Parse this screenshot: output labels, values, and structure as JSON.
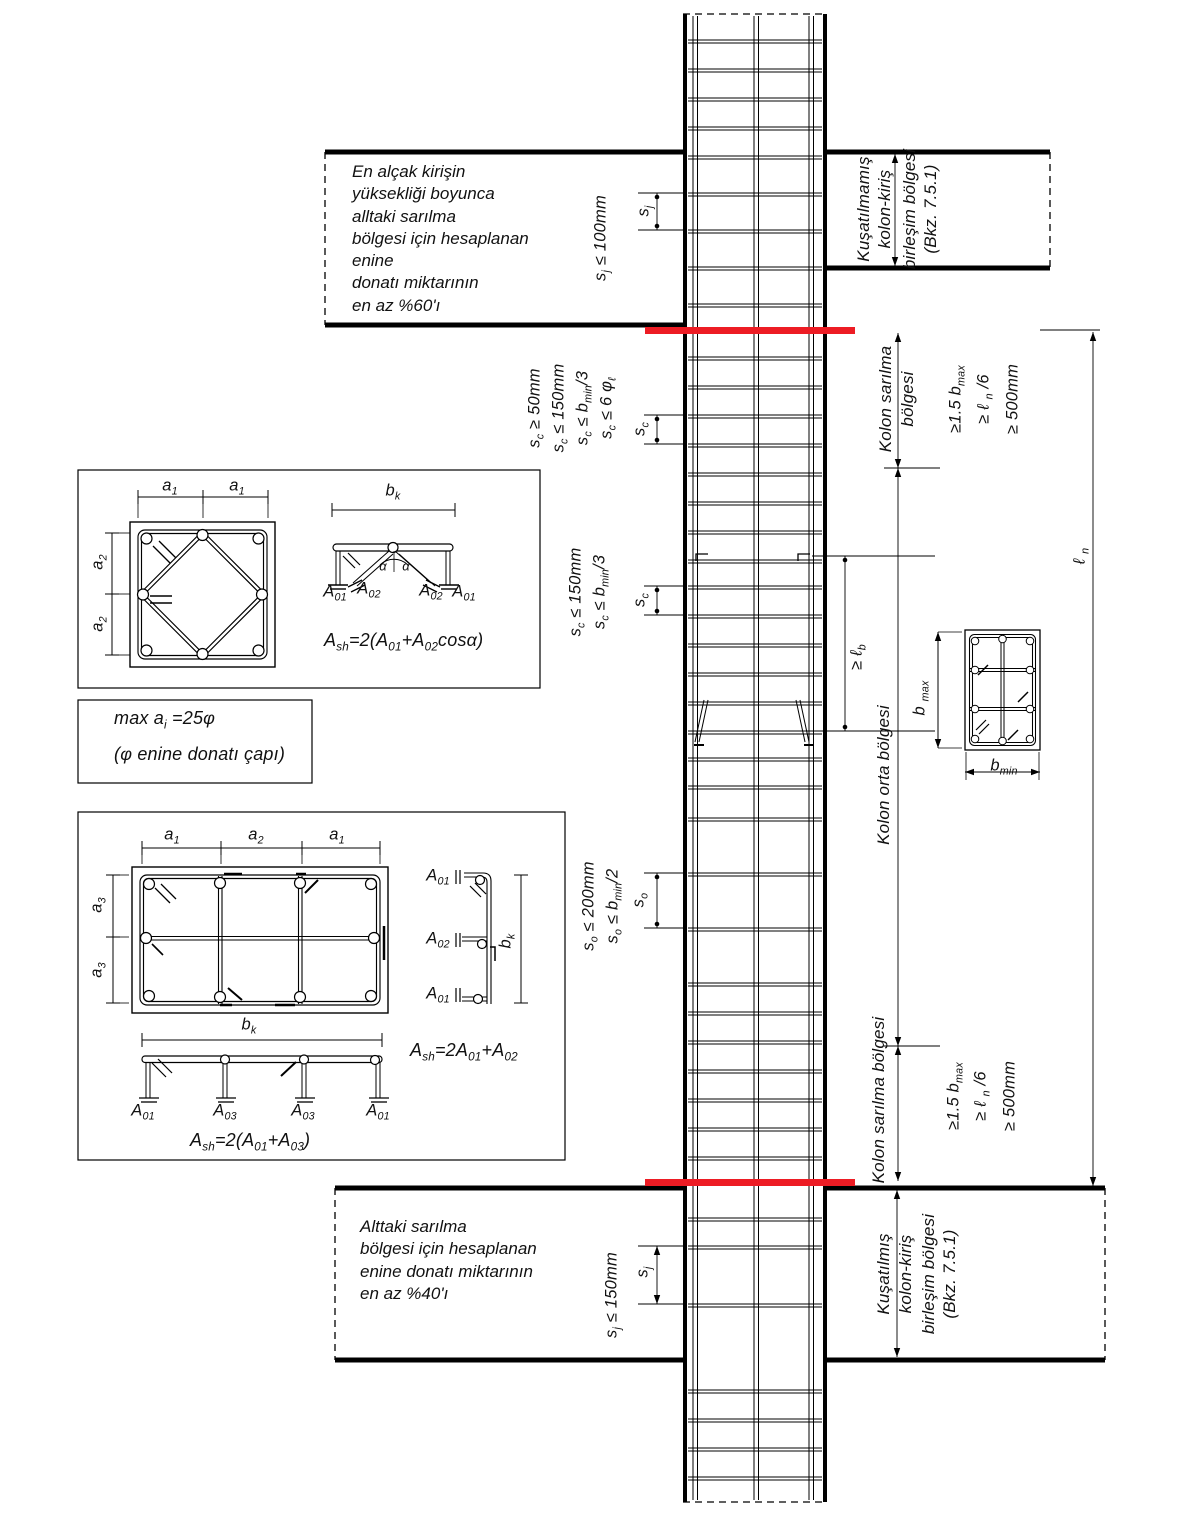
{
  "accent_color": "#ed1c24",
  "notes": {
    "top_left": "En alçak kirişin\nyüksekliği boyunca\nalltaki sarılma\nbölgesi için hesaplanan\nenine\ndonatı miktarının\nen az %60'ı",
    "bottom_left": "Alttaki sarılma\nbölgesi için hesaplanan\nenine donatı miktarının\nen az %40'ı",
    "max_spacing_1": "max a<sub>i</sub> =25φ",
    "max_spacing_2": "(φ enine donatı çapı)"
  },
  "joints": {
    "top": [
      "Kuşatılmamış",
      "kolon-kiriş",
      "birleşim bölgesi",
      "(Bkz. 7.5.1)"
    ],
    "bottom": [
      "Kuşatılmış",
      "kolon-kiriş",
      "birleşim bölgesi",
      "(Bkz. 7.5.1)"
    ]
  },
  "zones": {
    "top_confinement_1": "Kolon sarılma",
    "top_confinement_2": "bölgesi",
    "middle": "Kolon orta bölgesi",
    "bottom_confinement": "Kolon sarılma bölgesi",
    "limit_1": "≥1.5 b<sub>max</sub>",
    "limit_2": "≥ ℓ <sub>n</sub> /6",
    "limit_3": "≥ 500mm"
  },
  "spacing": {
    "sj_top_rule": "s<sub>j</sub> ≤ 100mm",
    "sj_bottom_rule": "s<sub>j</sub> ≤ 150mm",
    "sj_dim": "s<sub>j</sub>",
    "sc_dim": "s<sub>c</sub>",
    "so_dim": "s<sub>o</sub>",
    "sc_top_rule_1": "s<sub>c</sub> ≥ 50mm",
    "sc_top_rule_2": "s<sub>c</sub> ≤ 150mm",
    "sc_top_rule_3": "s<sub>c</sub> ≤ b<sub>min</sub>/3",
    "sc_top_rule_4": "s<sub>c</sub> ≤ 6 φ<sub>ℓ</sub>",
    "sc_mid_rule_1": "s<sub>c</sub> ≤ 150mm",
    "sc_mid_rule_2": "s<sub>c</sub> ≤ b<sub>min</sub>/3",
    "so_rule_1": "s<sub>o</sub> ≤ 200mm",
    "so_rule_2": "s<sub>o</sub> ≤ b<sub>min</sub>/2",
    "lap_length": "≥ ℓ<sub>b</sub>",
    "clear_height": "ℓ <sub>n</sub>"
  },
  "dims": {
    "a1": "a<sub>1</sub>",
    "a2": "a<sub>2</sub>",
    "a3": "a<sub>3</sub>",
    "bk": "b<sub>k</sub>",
    "bmax": "b <sub>max</sub>",
    "bmin": "b<sub>min</sub>",
    "alpha": "α"
  },
  "rebar": {
    "A01": "A<sub>01</sub>",
    "A02": "A<sub>02</sub>",
    "A03": "A<sub>03</sub>",
    "formula_sq": "A<sub>sh</sub>=2(A<sub>01</sub>+A<sub>02</sub>cosα)",
    "formula_rect_v": "A<sub>sh</sub>=2A<sub>01</sub>+A<sub>02</sub>",
    "formula_rect_h": "A<sub>sh</sub>=2(A<sub>01</sub>+A<sub>03</sub>)"
  }
}
